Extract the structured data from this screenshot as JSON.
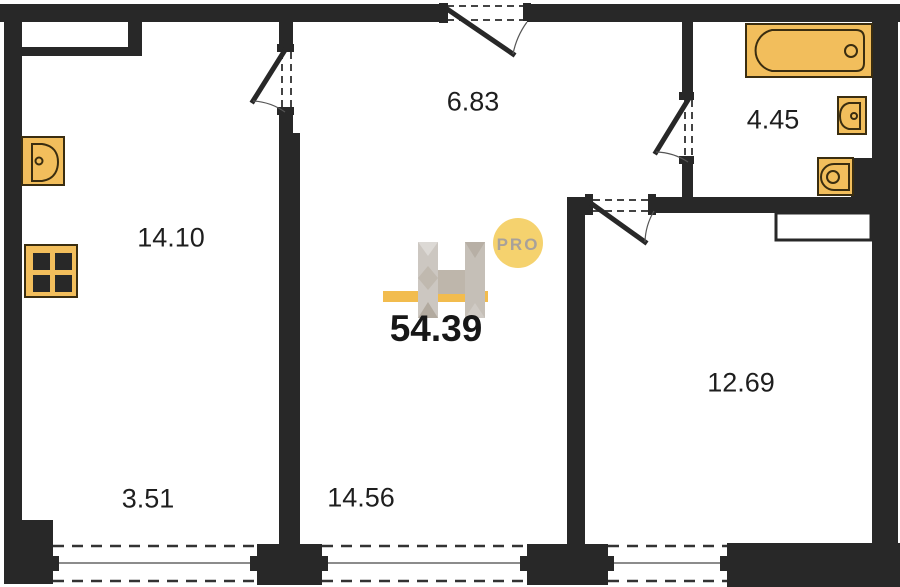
{
  "plan": {
    "total_area": "54.39",
    "logo": {
      "letter": "H",
      "badge": "PRO"
    },
    "rooms": [
      {
        "area": "14.10"
      },
      {
        "area": "6.83"
      },
      {
        "area": "4.45"
      },
      {
        "area": "12.69"
      },
      {
        "area": "3.51"
      },
      {
        "area": "14.56"
      }
    ],
    "fixtures": [
      "kitchen-sink-icon",
      "stove-icon",
      "bathtub-icon",
      "washbasin-icon",
      "toilet-icon"
    ],
    "colors": {
      "wall": "#282828",
      "fixture_fill": "#F2BE5C",
      "fixture_stroke": "#3A2D10",
      "accent_bar": "#F2BC4E",
      "badge_fill": "#F5D26E",
      "badge_text": "#A8A19A",
      "logo_gray": "#CCC7C1",
      "text": "#1E1E1E"
    }
  }
}
